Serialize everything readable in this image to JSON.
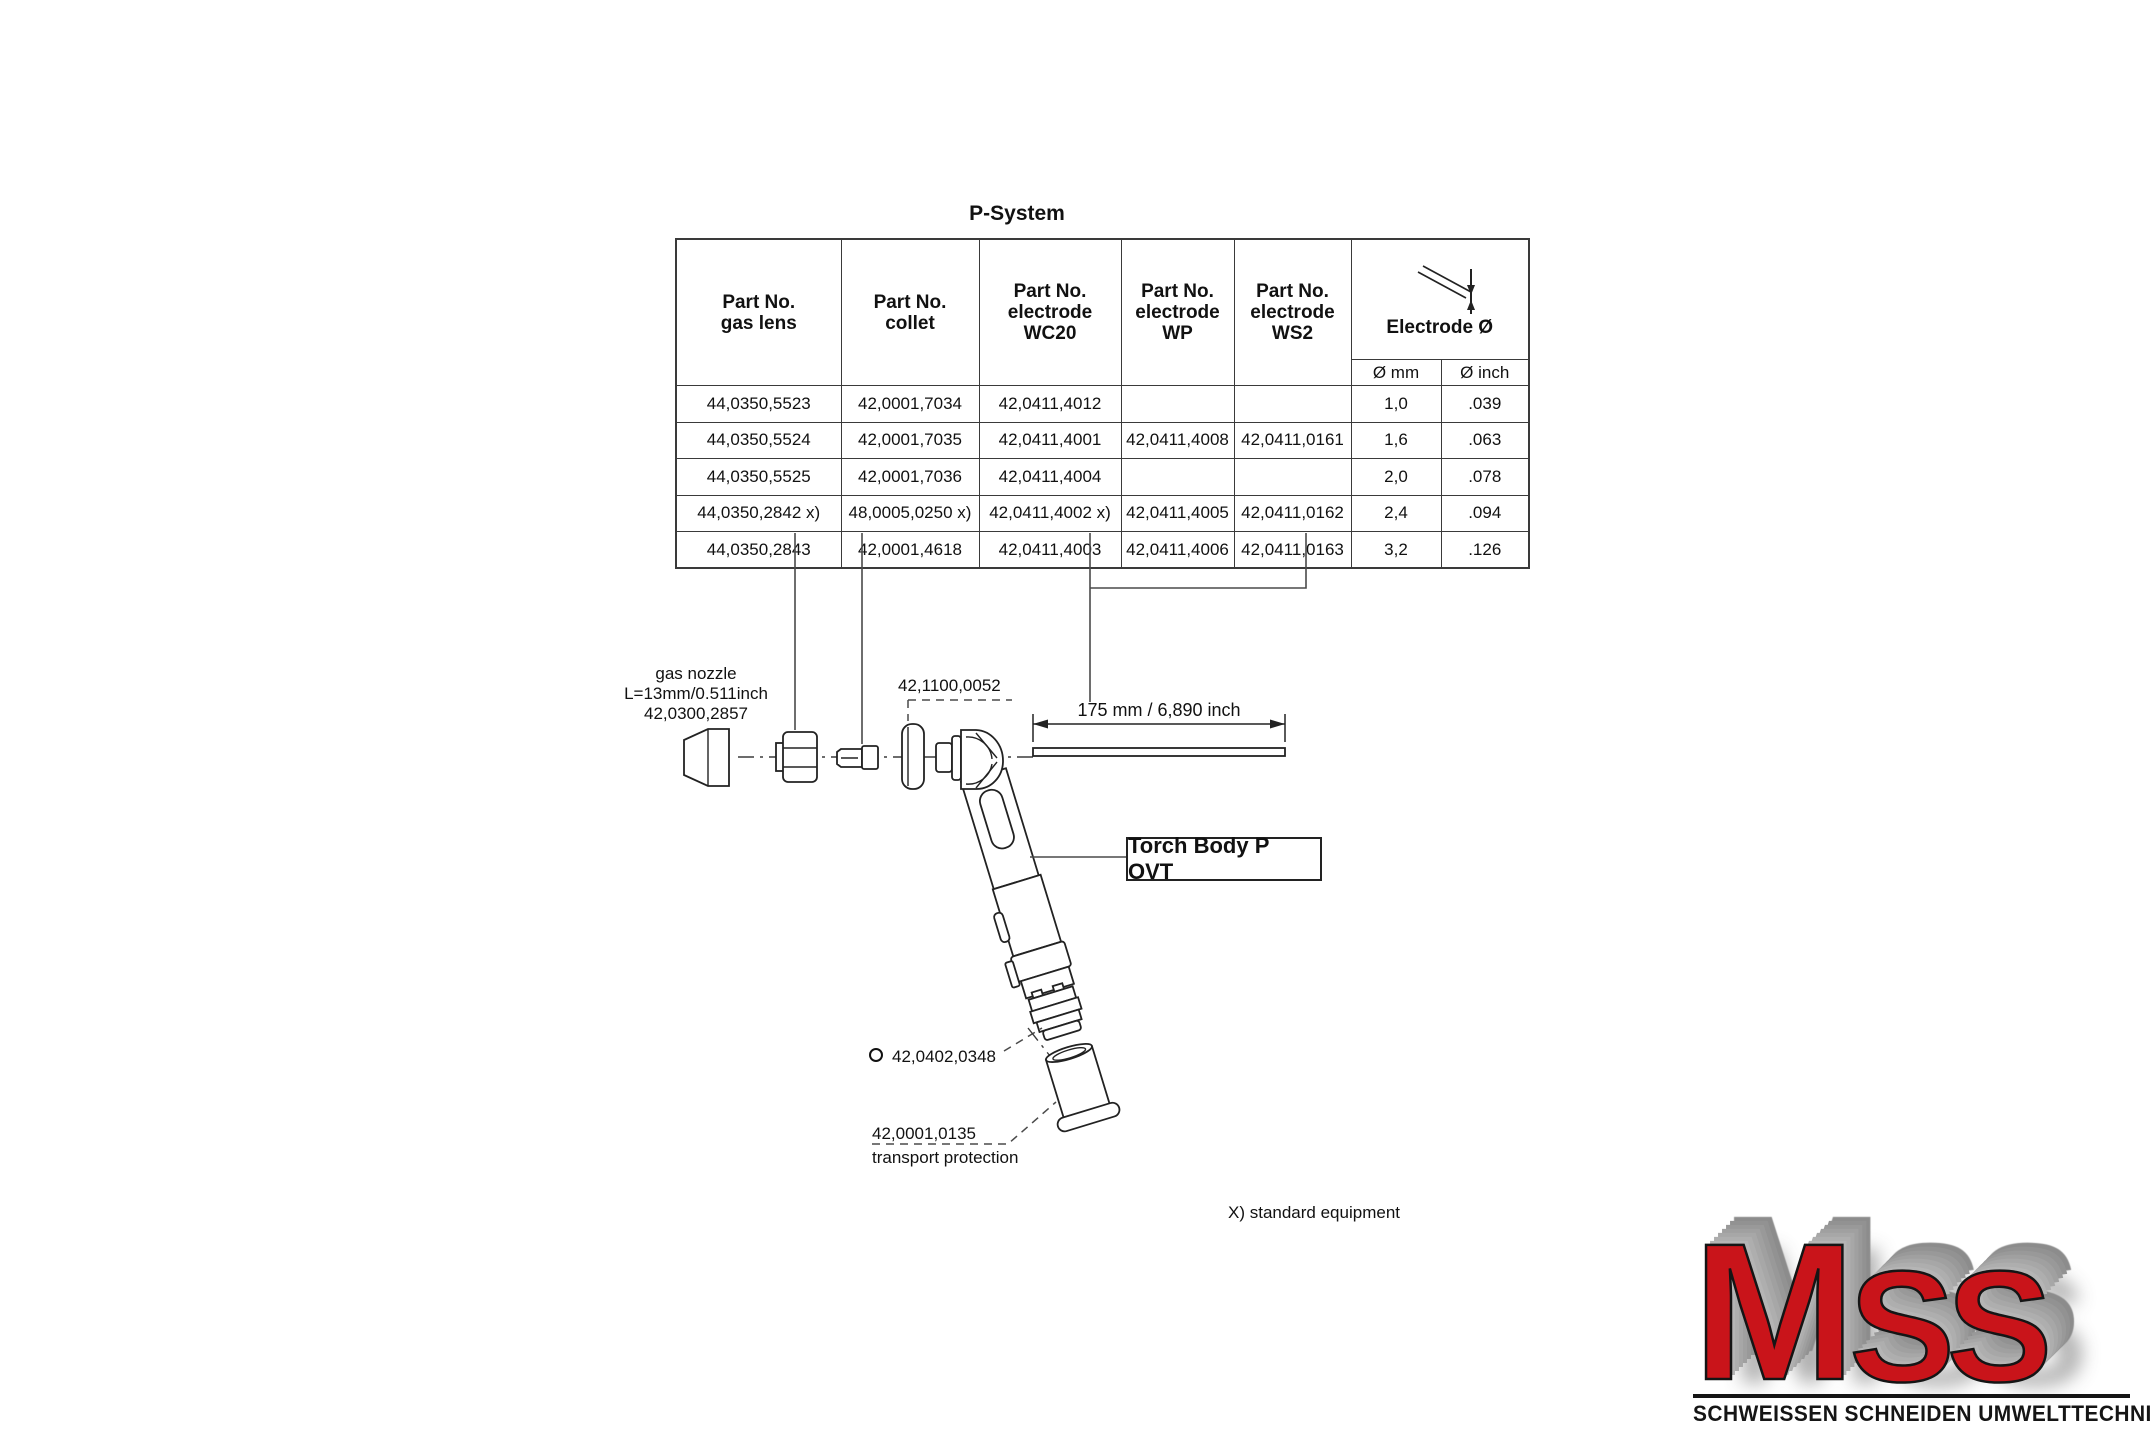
{
  "page": {
    "title": "P-System",
    "footnote": "X) standard equipment"
  },
  "table": {
    "columns": [
      "Part No.\ngas lens",
      "Part No.\ncollet",
      "Part No.\nelectrode\nWC20",
      "Part No.\nelectrode\nWP",
      "Part No.\nelectrode\nWS2"
    ],
    "dia_label": "Electrode Ø",
    "dia_sub": [
      "Ø mm",
      "Ø inch"
    ],
    "rows": [
      [
        "44,0350,5523",
        "42,0001,7034",
        "42,0411,4012",
        "",
        "",
        "1,0",
        ".039"
      ],
      [
        "44,0350,5524",
        "42,0001,7035",
        "42,0411,4001",
        "42,0411,4008",
        "42,0411,0161",
        "1,6",
        ".063"
      ],
      [
        "44,0350,5525",
        "42,0001,7036",
        "42,0411,4004",
        "",
        "",
        "2,0",
        ".078"
      ],
      [
        "44,0350,2842 x)",
        "48,0005,0250 x)",
        "42,0411,4002 x)",
        "42,0411,4005",
        "42,0411,0162",
        "2,4",
        ".094"
      ],
      [
        "44,0350,2843",
        "42,0001,4618",
        "42,0411,4003",
        "42,0411,4006",
        "42,0411,0163",
        "3,2",
        ".126"
      ]
    ]
  },
  "diagram": {
    "gas_nozzle_label": "gas nozzle\nL=13mm/0.511inch\n42,0300,2857",
    "lens_insert_label": "42,1100,0052",
    "electrode_dimension": "175 mm / 6,890 inch",
    "torch_body_label": "Torch Body P OVT",
    "oring_label": "42,0402,0348",
    "transport_part_no": "42,0001,0135",
    "transport_name": "transport protection"
  },
  "logo": {
    "letter_m": "M",
    "letters_ss": "SS",
    "caption": "SCHWEISSEN SCHNEIDEN UMWELTTECHNIK",
    "brand_red": "#c9141a",
    "bevel_gray": "#9a9a9a",
    "line_black": "#151515"
  }
}
